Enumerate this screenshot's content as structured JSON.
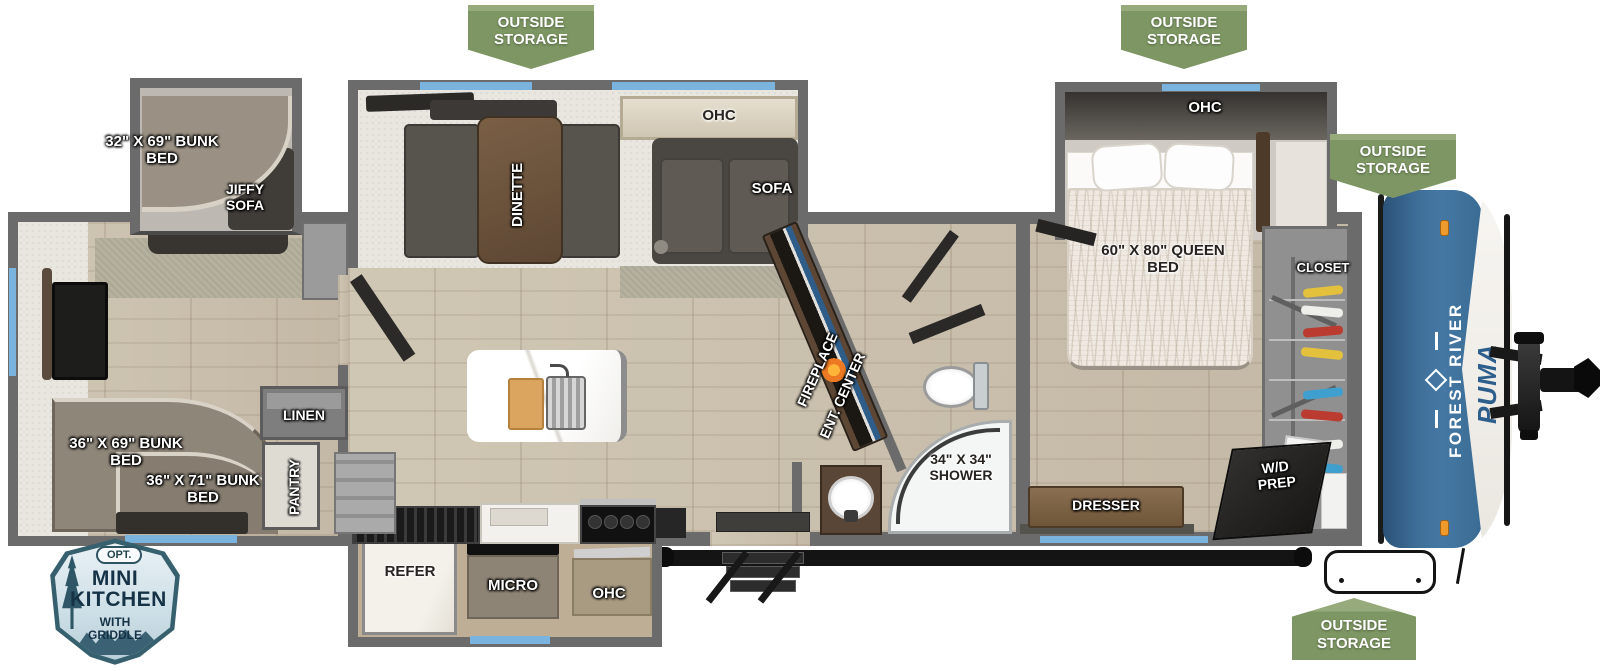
{
  "badges": {
    "outside_storage_label": "OUTSIDE STORAGE"
  },
  "option_badge": {
    "opt": "OPT.",
    "title": "MINI KITCHEN",
    "subtitle": "WITH GRIDDLE"
  },
  "brand": {
    "make": "FOREST RIVER",
    "model": "PUMA"
  },
  "labels": {
    "rear_slide_bunk": "32\" X 69\" BUNK BED",
    "jiffy_sofa": "JIFFY SOFA",
    "living_ohc": "OHC",
    "dinette": "DINETTE",
    "sofa": "SOFA",
    "fireplace": "FIREPLACE",
    "ent_center": "ENT. CENTER",
    "shower": "34\" X 34\" SHOWER",
    "bedroom_ohc": "OHC",
    "queen_bed": "60\" X 80\" QUEEN BED",
    "closet": "CLOSET",
    "dresser": "DRESSER",
    "wd_prep": "W/D PREP",
    "rear_bunk_upper": "36\" X 69\" BUNK BED",
    "rear_bunk_lower": "36\" X 71\" BUNK BED",
    "linen": "LINEN",
    "pantry": "PANTRY",
    "refer": "REFER",
    "micro": "MICRO",
    "kitchen_ohc": "OHC"
  },
  "colors": {
    "badge_green": "#7D9663",
    "cap_blue": "#3A6B93",
    "window_blue": "#7AB3DD",
    "wall_gray": "#6B6B6B"
  }
}
